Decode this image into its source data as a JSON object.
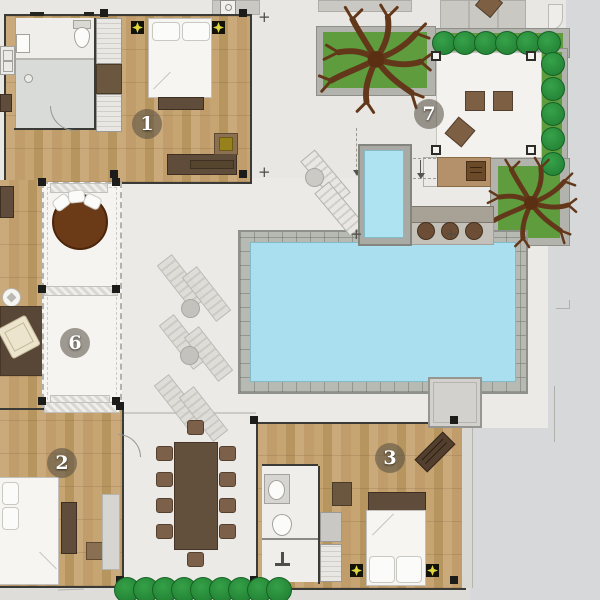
{
  "plan": {
    "type": "villa-floor-plan",
    "badges": [
      {
        "room": "bedroom-1",
        "label": "1"
      },
      {
        "room": "bedroom-2",
        "label": "2"
      },
      {
        "room": "bedroom-3",
        "label": "3"
      },
      {
        "room": "sala-pavilion",
        "label": "6"
      },
      {
        "room": "lounge-terrace",
        "label": "7"
      }
    ],
    "survey_marker_glyph": "+",
    "colors": {
      "canvas_bg": "#e8e7e3",
      "outside_bg": "#d6d8d9",
      "wood_floor": "#c2a06e",
      "interior_floor": "#efeeeb",
      "pool_water": "#a9dfef",
      "pool_tile": "#b7b9b3",
      "planter_grass": "#5e9c3e",
      "shrub_green": "#27913b",
      "hedge_green": "#27913b",
      "tree_branch_brown": "#63381a",
      "daybed_brown": "#6b3a16",
      "dark_furniture": "#5f4c3a",
      "counter_tan": "#b4916b",
      "badge_fill": "rgba(84,77,63,0.55)",
      "badge_text": "#ffffff",
      "spotlight_yellow": "#ded63c",
      "wall_line": "#3a3a36"
    }
  }
}
